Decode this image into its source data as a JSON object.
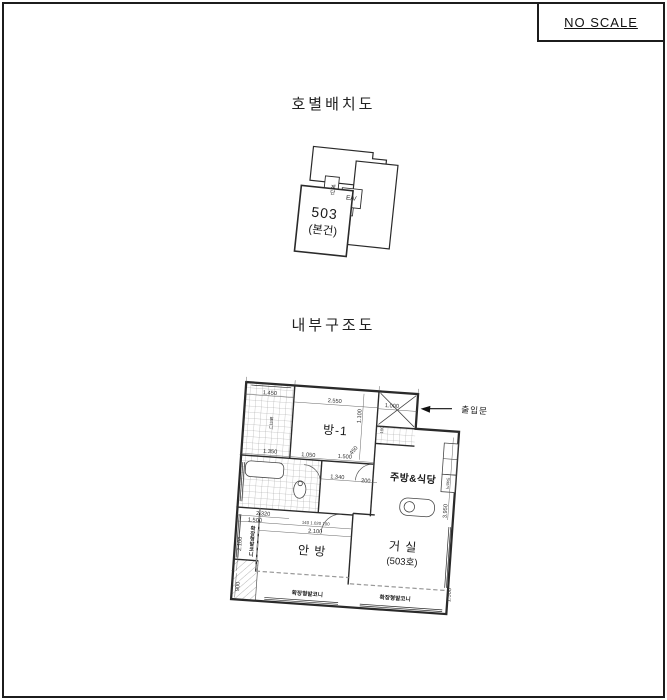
{
  "frame": {
    "no_scale": "NO SCALE"
  },
  "unit_diagram": {
    "title": "호별배치도",
    "stairs": "계단",
    "elevator": "E/V",
    "unit_number": "503",
    "unit_note": "(본건)"
  },
  "floor_plan": {
    "title": "내부구조도",
    "entrance_label": "출입문",
    "rooms": {
      "room1": "방-1",
      "kitchen": "주방&식당",
      "master": "안 방",
      "living_line1": "거 실",
      "living_line2": "(503호)",
      "utility": "발코니",
      "fridge": "냉장고"
    },
    "balconies": {
      "left_vertical": "확장형발코니",
      "bottom_left": "확장형발코니",
      "bottom_right": "확장형발코니"
    },
    "dims": {
      "d1": "1.450",
      "d2": "2.550",
      "d3": "1.000",
      "d4": "1.100",
      "d5": "100",
      "d6": "450",
      "d7": "1.350",
      "d8": "1.050",
      "d9": "1.500",
      "d10": "1.340",
      "d11": "200",
      "d12": "2.320",
      "d13": "1.500",
      "d14": "140 1.020 100",
      "d15": "2.100",
      "d16": "2.100",
      "d17": "900",
      "d18": "3.950",
      "d19": "1.500"
    },
    "colors": {
      "wall": "#2a2a2a",
      "hatch": "#9a9a9a",
      "dim_line": "#555555",
      "dashed": "#999999"
    }
  }
}
